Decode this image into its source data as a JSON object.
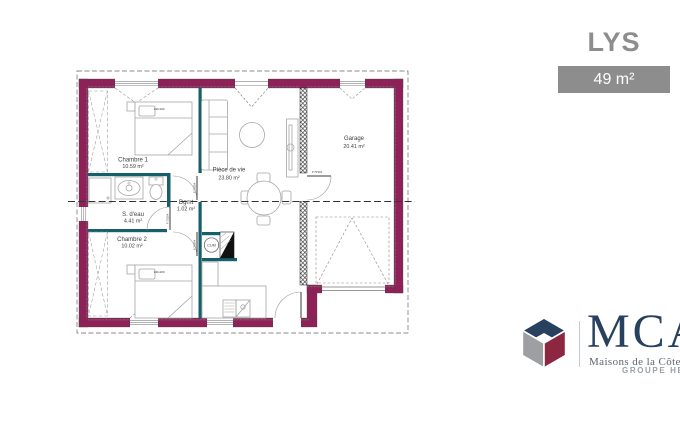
{
  "title": {
    "name": "LYS",
    "area_badge": "49 m²"
  },
  "plan": {
    "rooms": [
      {
        "name": "Chambre 1",
        "area": "10.59 m²"
      },
      {
        "name": "S. d'eau",
        "area": "4.41 m²"
      },
      {
        "name": "Chambre 2",
        "area": "10.02 m²"
      },
      {
        "name": "Dgmt",
        "area": "1.02 m²"
      },
      {
        "name": "Pièce de vie",
        "area": "23.80 m²"
      },
      {
        "name": "Garage",
        "area": "20.41 m²"
      }
    ],
    "labels": {
      "bed_size": "140x200",
      "water_heater": "CUM",
      "door": "P 75/204"
    },
    "colors": {
      "exterior_wall": "#8e2158",
      "partition": "#15606a",
      "furniture_line": "#a5a5a5"
    }
  },
  "branding": {
    "logo_text": "MCA",
    "logo_subtitle": "Maisons de la Côte Atlantique",
    "group": "GROUPE HEXAÔM",
    "colors": {
      "navy": "#27415e",
      "maroon": "#8d2741",
      "gray": "#9d9fa2"
    }
  }
}
